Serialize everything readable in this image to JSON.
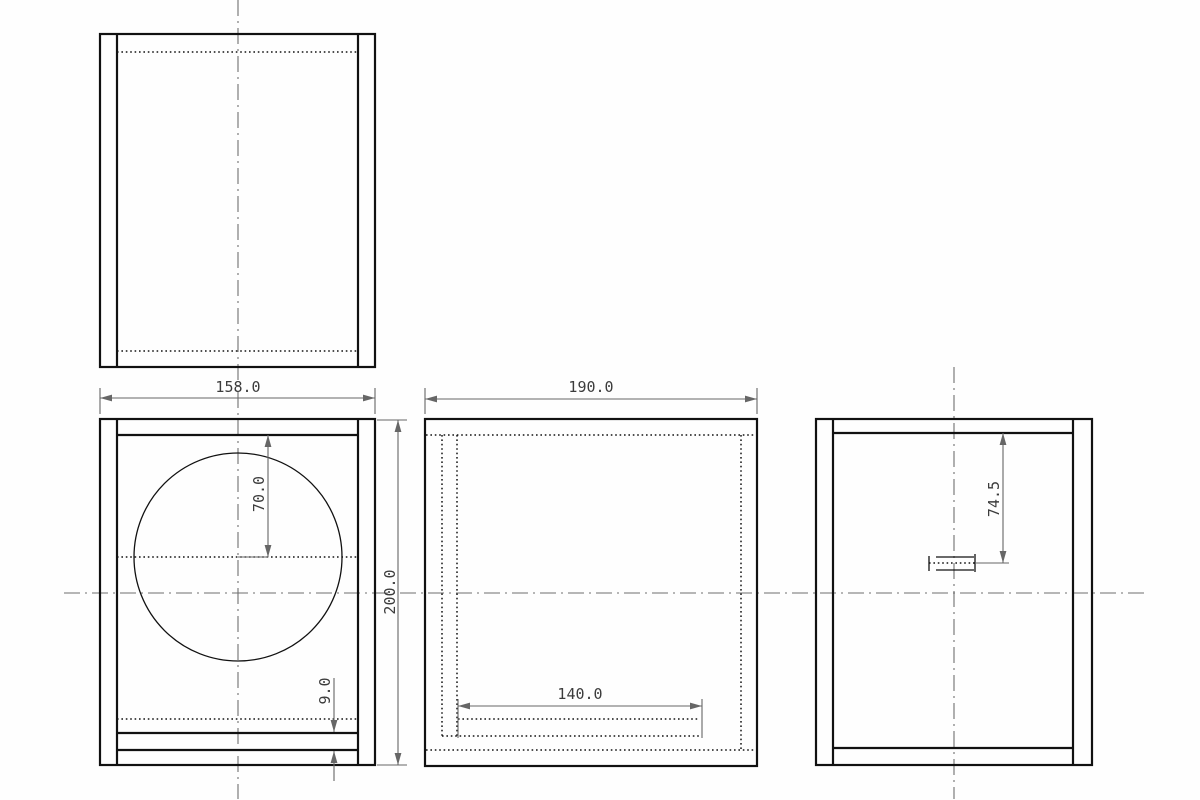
{
  "colors": {
    "object_line": "#111111",
    "hidden_line": "#141414",
    "centerline": "#6f6f6f",
    "dimension_line": "#666666",
    "text": "#3c3c3c",
    "background": "#fefefe"
  },
  "dims": {
    "front_width": "158.0",
    "depth": "190.0",
    "driver_center_from_top": "70.0",
    "height": "200.0",
    "slot_thickness": "9.0",
    "duct_length": "140.0",
    "terminal_from_top": "74.5"
  }
}
